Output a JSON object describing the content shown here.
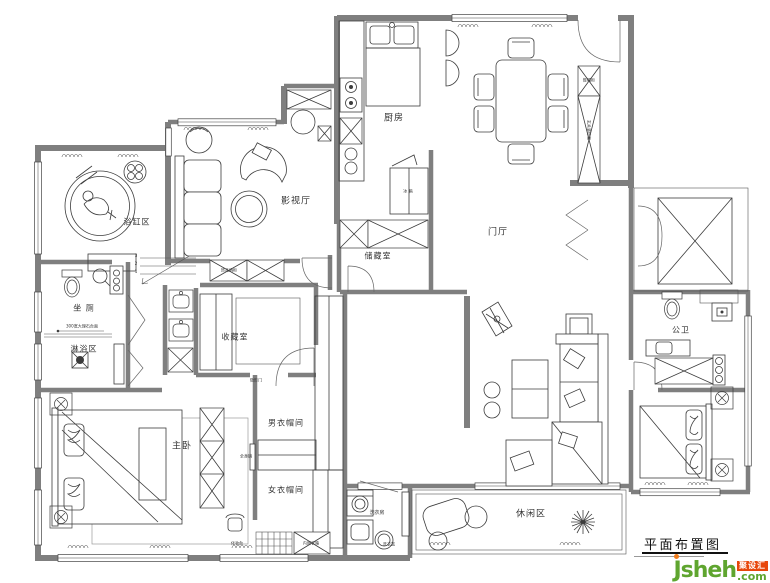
{
  "rooms": {
    "bathtub": "浴缸区",
    "toilet": "坐 厕",
    "shower": "淋浴区",
    "media": "影视厅",
    "kitchen": "厨房",
    "foyer": "门厅",
    "storage": "储藏室",
    "collection": "收藏室",
    "master": "主卧",
    "men_closet": "男衣帽间",
    "women_closet": "女衣帽间",
    "laundry": "洗衣房",
    "leisure": "休闲区",
    "guest_bath": "公卫"
  },
  "annotations": {
    "fridge": "冰 箱",
    "full_mirror": "全身镜",
    "laundry_basket": "洗衣篮",
    "vanity_table": "化妆台",
    "built_in_box": "内嵌衣箱",
    "deco_wine_cabinet": "饰品酒柜",
    "shoe_cabinet": "鞋帽柜",
    "entry_cabinet": "玄关装饰柜",
    "hidden_door": "隐形门",
    "marble_sill": "300宽大理石台面",
    "step3": "3",
    "step2": "2",
    "step1": "1"
  },
  "title_block": {
    "title": "平面布置图"
  },
  "logo": {
    "brand": "Jsheh",
    "tld": ".com",
    "badge": "聚设汇"
  },
  "colors": {
    "wall": "#7f7f7f",
    "line": "#3c3c3c",
    "logo_green": "#5fa52f",
    "logo_orange": "#e8470b",
    "dot_orange": "#f07b1a"
  }
}
